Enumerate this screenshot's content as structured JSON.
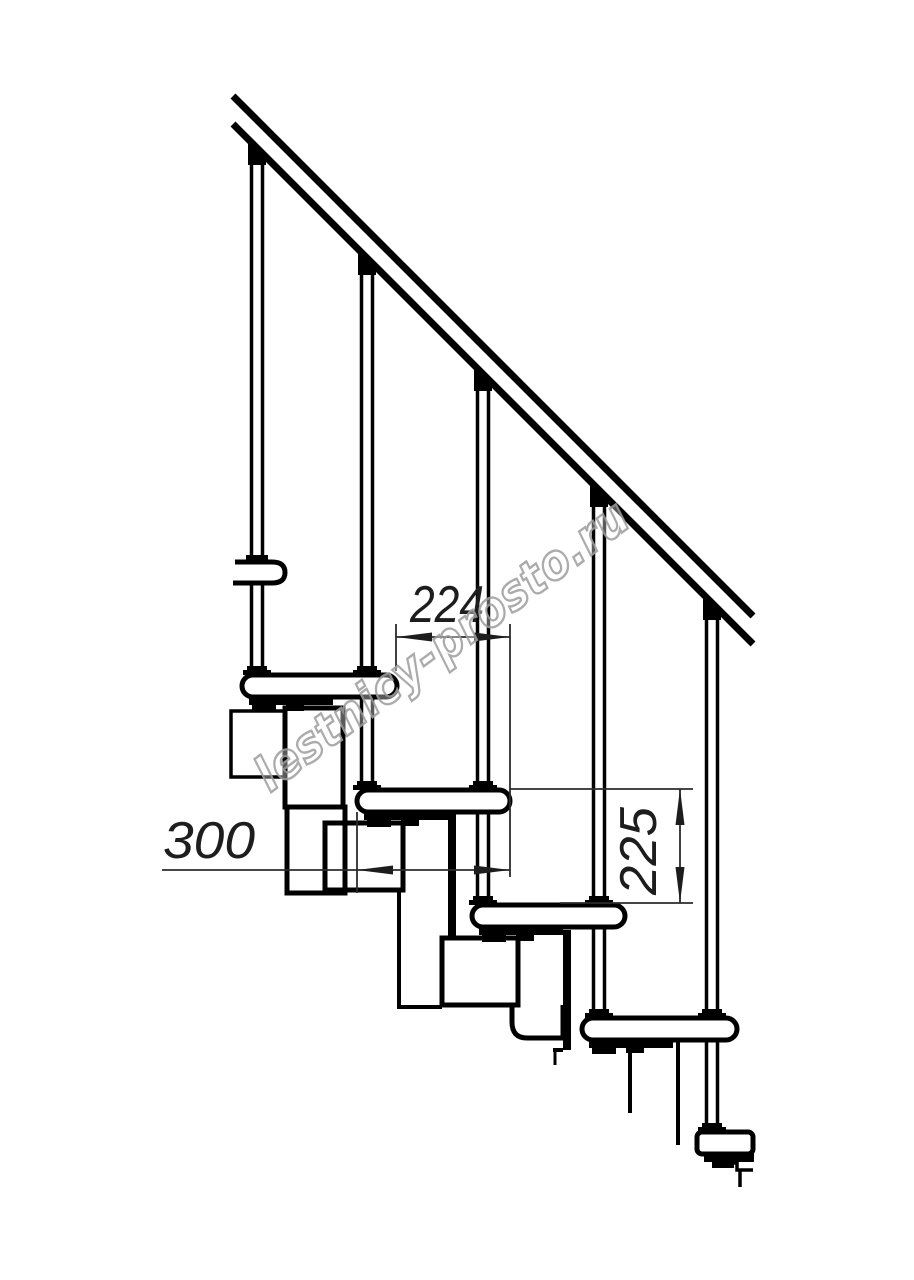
{
  "page": {
    "background": "#ffffff"
  },
  "drawing": {
    "kind": "Modular staircase side elevation - technical line drawing",
    "dimensions": {
      "going": {
        "value": "224"
      },
      "tread_depth": {
        "value": "300"
      },
      "riser": {
        "value": "225"
      }
    },
    "watermark": {
      "text": "lestnicy-prosto.ru",
      "color": "#a0a0a0"
    },
    "colors": {
      "line": "#000000",
      "dimension": "#2b2b2b",
      "background": "#ffffff"
    }
  }
}
